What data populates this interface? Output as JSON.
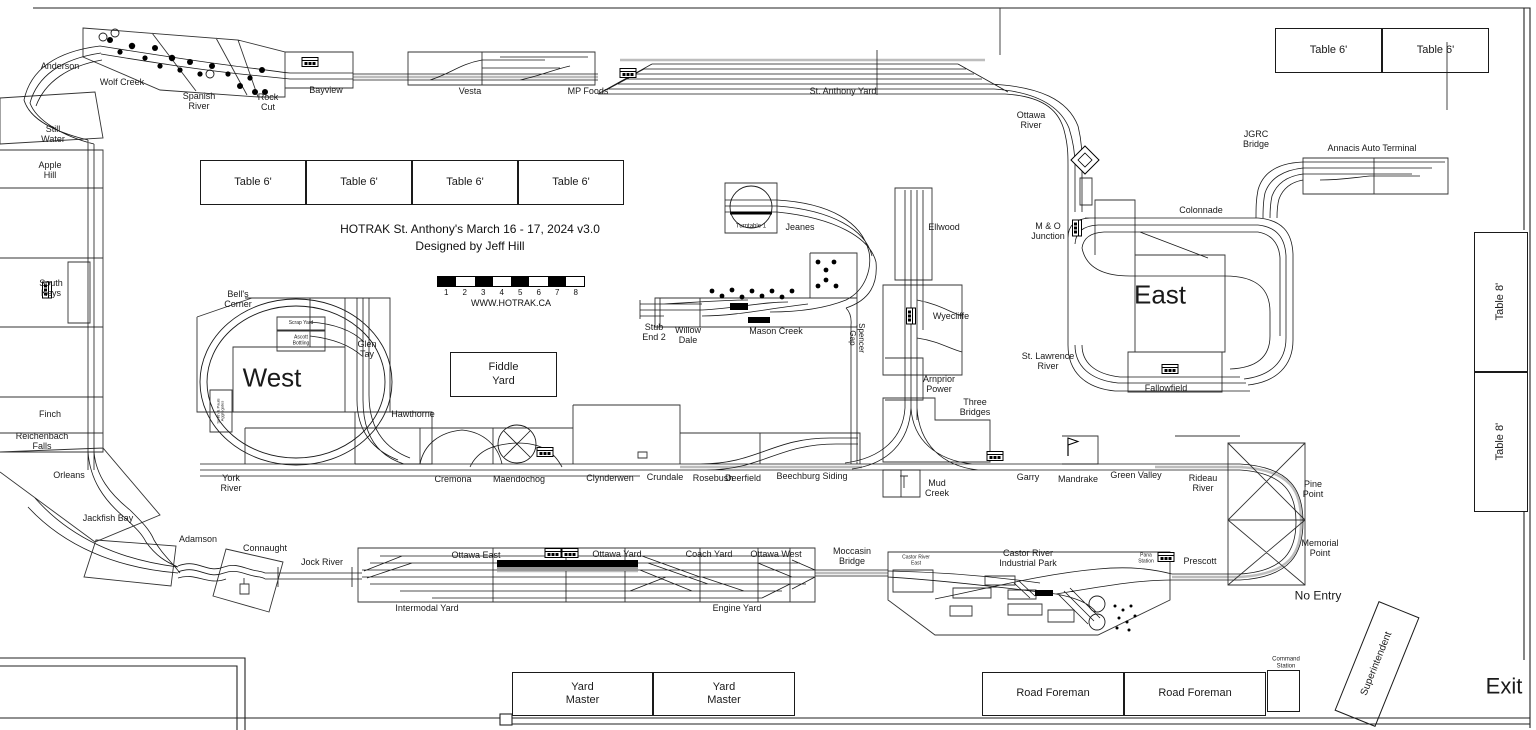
{
  "meta": {
    "title_line1": "HOTRAK St. Anthony's March 16 - 17, 2024 v3.0",
    "title_line2": "Designed by Jeff Hill",
    "website": "WWW.HOTRAK.CA",
    "scale_numbers": [
      "1",
      "2",
      "3",
      "4",
      "5",
      "6",
      "7",
      "8"
    ],
    "accent_color": "#1a1a1a"
  },
  "labels": [
    {
      "t": "Anderson",
      "x": 60,
      "y": 66,
      "fs": 9
    },
    {
      "t": "Wolf Creek",
      "x": 122,
      "y": 82,
      "fs": 9
    },
    {
      "t": "Spanish\nRiver",
      "x": 199,
      "y": 101,
      "fs": 9
    },
    {
      "t": "Rock\nCut",
      "x": 268,
      "y": 102,
      "fs": 9
    },
    {
      "t": "Bayview",
      "x": 326,
      "y": 90,
      "fs": 9
    },
    {
      "t": "Vesta",
      "x": 470,
      "y": 91,
      "fs": 9
    },
    {
      "t": "MP Foods",
      "x": 588,
      "y": 91,
      "fs": 9
    },
    {
      "t": "St. Anthony Yard",
      "x": 843,
      "y": 91,
      "fs": 9
    },
    {
      "t": "Ottawa\nRiver",
      "x": 1031,
      "y": 120,
      "fs": 9
    },
    {
      "t": "JGRC\nBridge",
      "x": 1256,
      "y": 139,
      "fs": 9
    },
    {
      "t": "Annacis Auto Terminal",
      "x": 1372,
      "y": 148,
      "fs": 9
    },
    {
      "t": "Colonnade",
      "x": 1201,
      "y": 210,
      "fs": 9
    },
    {
      "t": "Still\nWater",
      "x": 53,
      "y": 134,
      "fs": 9
    },
    {
      "t": "Apple\nHill",
      "x": 50,
      "y": 170,
      "fs": 9
    },
    {
      "t": "South\nKeys",
      "x": 51,
      "y": 288,
      "fs": 9
    },
    {
      "t": "Finch",
      "x": 50,
      "y": 414,
      "fs": 9
    },
    {
      "t": "Reichenbach\nFalls",
      "x": 42,
      "y": 441,
      "fs": 9
    },
    {
      "t": "Orleans",
      "x": 69,
      "y": 475,
      "fs": 9
    },
    {
      "t": "Jackfish Bay",
      "x": 108,
      "y": 518,
      "fs": 9
    },
    {
      "t": "Adamson",
      "x": 198,
      "y": 539,
      "fs": 9
    },
    {
      "t": "Connaught",
      "x": 265,
      "y": 548,
      "fs": 9
    },
    {
      "t": "Jock River",
      "x": 322,
      "y": 562,
      "fs": 9
    },
    {
      "t": "Turntable 1",
      "x": 751,
      "y": 227,
      "fs": 6
    },
    {
      "t": "Jeanes",
      "x": 800,
      "y": 227,
      "fs": 9
    },
    {
      "t": "Ellwood",
      "x": 944,
      "y": 227,
      "fs": 9
    },
    {
      "t": "M & O\nJunction",
      "x": 1048,
      "y": 231,
      "fs": 9
    },
    {
      "t": "East",
      "x": 1160,
      "y": 295,
      "fs": 26
    },
    {
      "t": "St. Lawrence\nRiver",
      "x": 1048,
      "y": 361,
      "fs": 9
    },
    {
      "t": "Fallowfield",
      "x": 1166,
      "y": 388,
      "fs": 9
    },
    {
      "t": "Stub\nEnd 2",
      "x": 654,
      "y": 332,
      "fs": 9
    },
    {
      "t": "Willow\nDale",
      "x": 688,
      "y": 335,
      "fs": 9
    },
    {
      "t": "Mason Creek",
      "x": 776,
      "y": 331,
      "fs": 9
    },
    {
      "t": "Spencer\nGap",
      "x": 856,
      "y": 338,
      "fs": 8,
      "r": 90
    },
    {
      "t": "Wyecliffe",
      "x": 951,
      "y": 316,
      "fs": 9
    },
    {
      "t": "Bell's\nCorner",
      "x": 238,
      "y": 299,
      "fs": 9
    },
    {
      "t": "Scrap Yard",
      "x": 301,
      "y": 324,
      "fs": 5
    },
    {
      "t": "Ascott\nBottling",
      "x": 301,
      "y": 341,
      "fs": 5
    },
    {
      "t": "West",
      "x": 272,
      "y": 378,
      "fs": 26
    },
    {
      "t": "Glen\nTay",
      "x": 367,
      "y": 349,
      "fs": 9
    },
    {
      "t": "Smith & Pauls\nAggregates",
      "x": 221,
      "y": 411,
      "fs": 4,
      "r": -90
    },
    {
      "t": "Hawthorne",
      "x": 413,
      "y": 414,
      "fs": 9
    },
    {
      "t": "Arnprior\nPower",
      "x": 939,
      "y": 384,
      "fs": 9
    },
    {
      "t": "Three\nBridges",
      "x": 975,
      "y": 407,
      "fs": 9
    },
    {
      "t": "York\nRiver",
      "x": 231,
      "y": 483,
      "fs": 9
    },
    {
      "t": "Cremona",
      "x": 453,
      "y": 479,
      "fs": 9
    },
    {
      "t": "Maendochog",
      "x": 519,
      "y": 479,
      "fs": 9
    },
    {
      "t": "Clynderwen",
      "x": 610,
      "y": 478,
      "fs": 9
    },
    {
      "t": "Crundale",
      "x": 665,
      "y": 477,
      "fs": 9
    },
    {
      "t": "Rosebush",
      "x": 713,
      "y": 478,
      "fs": 9
    },
    {
      "t": "Deerfield",
      "x": 743,
      "y": 478,
      "fs": 9
    },
    {
      "t": "Beechburg Siding",
      "x": 812,
      "y": 476,
      "fs": 9
    },
    {
      "t": "Mud\nCreek",
      "x": 937,
      "y": 488,
      "fs": 9
    },
    {
      "t": "Garry",
      "x": 1028,
      "y": 477,
      "fs": 9
    },
    {
      "t": "Mandrake",
      "x": 1078,
      "y": 479,
      "fs": 9
    },
    {
      "t": "Green Valley",
      "x": 1136,
      "y": 475,
      "fs": 9
    },
    {
      "t": "Rideau\nRiver",
      "x": 1203,
      "y": 483,
      "fs": 9
    },
    {
      "t": "Pine\nPoint",
      "x": 1313,
      "y": 489,
      "fs": 9
    },
    {
      "t": "Memorial\nPoint",
      "x": 1320,
      "y": 548,
      "fs": 9
    },
    {
      "t": "Moccasin\nBridge",
      "x": 852,
      "y": 556,
      "fs": 9
    },
    {
      "t": "Ottawa East",
      "x": 476,
      "y": 555,
      "fs": 9
    },
    {
      "t": "Ottawa Yard",
      "x": 617,
      "y": 554,
      "fs": 9
    },
    {
      "t": "Coach Yard",
      "x": 709,
      "y": 554,
      "fs": 9
    },
    {
      "t": "Ottawa West",
      "x": 776,
      "y": 554,
      "fs": 9
    },
    {
      "t": "Castor River\nEast",
      "x": 916,
      "y": 561,
      "fs": 5
    },
    {
      "t": "Castor River\nIndustrial Park",
      "x": 1028,
      "y": 558,
      "fs": 9
    },
    {
      "t": "Pana\nStation",
      "x": 1146,
      "y": 559,
      "fs": 5
    },
    {
      "t": "Prescott",
      "x": 1200,
      "y": 561,
      "fs": 9
    },
    {
      "t": "Intermodal Yard",
      "x": 427,
      "y": 608,
      "fs": 9
    },
    {
      "t": "Engine Yard",
      "x": 737,
      "y": 608,
      "fs": 9
    },
    {
      "t": "No Entry",
      "x": 1318,
      "y": 596,
      "fs": 12
    },
    {
      "t": "Command\nStation",
      "x": 1286,
      "y": 663,
      "fs": 6
    },
    {
      "t": "Exit",
      "x": 1504,
      "y": 687,
      "fs": 22
    }
  ],
  "boxes": [
    {
      "label": "Table 6'",
      "x": 200,
      "y": 160,
      "w": 106,
      "h": 45,
      "fs": 11
    },
    {
      "label": "Table 6'",
      "x": 306,
      "y": 160,
      "w": 106,
      "h": 45,
      "fs": 11
    },
    {
      "label": "Table 6'",
      "x": 412,
      "y": 160,
      "w": 106,
      "h": 45,
      "fs": 11
    },
    {
      "label": "Table 6'",
      "x": 518,
      "y": 160,
      "w": 106,
      "h": 45,
      "fs": 11
    },
    {
      "label": "Table 6'",
      "x": 1275,
      "y": 28,
      "w": 107,
      "h": 45,
      "fs": 11
    },
    {
      "label": "Table 6'",
      "x": 1382,
      "y": 28,
      "w": 107,
      "h": 45,
      "fs": 11
    },
    {
      "label": "Table 8'",
      "x": 1474,
      "y": 232,
      "w": 54,
      "h": 140,
      "fs": 11,
      "labelRot": -90
    },
    {
      "label": "Table 8'",
      "x": 1474,
      "y": 372,
      "w": 54,
      "h": 140,
      "fs": 11,
      "labelRot": -90
    },
    {
      "label": "Fiddle\nYard",
      "x": 450,
      "y": 352,
      "w": 107,
      "h": 45,
      "fs": 11
    },
    {
      "label": "Yard\nMaster",
      "x": 512,
      "y": 672,
      "w": 141,
      "h": 44,
      "fs": 11
    },
    {
      "label": "Yard\nMaster",
      "x": 653,
      "y": 672,
      "w": 142,
      "h": 44,
      "fs": 11
    },
    {
      "label": "Road Foreman",
      "x": 982,
      "y": 672,
      "w": 142,
      "h": 44,
      "fs": 11
    },
    {
      "label": "Road Foreman",
      "x": 1124,
      "y": 672,
      "w": 142,
      "h": 44,
      "fs": 11
    },
    {
      "label": "",
      "x": 1267,
      "y": 670,
      "w": 33,
      "h": 42,
      "fs": 6
    },
    {
      "label": "Superintendent",
      "x": 1355,
      "y": 605,
      "w": 44,
      "h": 118,
      "fs": 10,
      "boxRot": 22,
      "labelRot": -90
    }
  ],
  "icons": [
    {
      "t": "station",
      "x": 310,
      "y": 62,
      "r": 0
    },
    {
      "t": "station",
      "x": 47,
      "y": 290,
      "r": 90
    },
    {
      "t": "station",
      "x": 628,
      "y": 73,
      "r": 0
    },
    {
      "t": "station",
      "x": 553,
      "y": 553,
      "r": 0
    },
    {
      "t": "station",
      "x": 570,
      "y": 553,
      "r": 0
    },
    {
      "t": "station",
      "x": 545,
      "y": 452,
      "r": 0
    },
    {
      "t": "station",
      "x": 995,
      "y": 456,
      "r": 0
    },
    {
      "t": "station",
      "x": 911,
      "y": 316,
      "r": 90
    },
    {
      "t": "station",
      "x": 1077,
      "y": 228,
      "r": 90
    },
    {
      "t": "station",
      "x": 1170,
      "y": 369,
      "r": 0
    },
    {
      "t": "station",
      "x": 1166,
      "y": 557,
      "r": 0
    },
    {
      "t": "flag",
      "x": 1068,
      "y": 447,
      "r": 0
    },
    {
      "t": "diamond",
      "x": 1085,
      "y": 160,
      "r": 0
    }
  ]
}
